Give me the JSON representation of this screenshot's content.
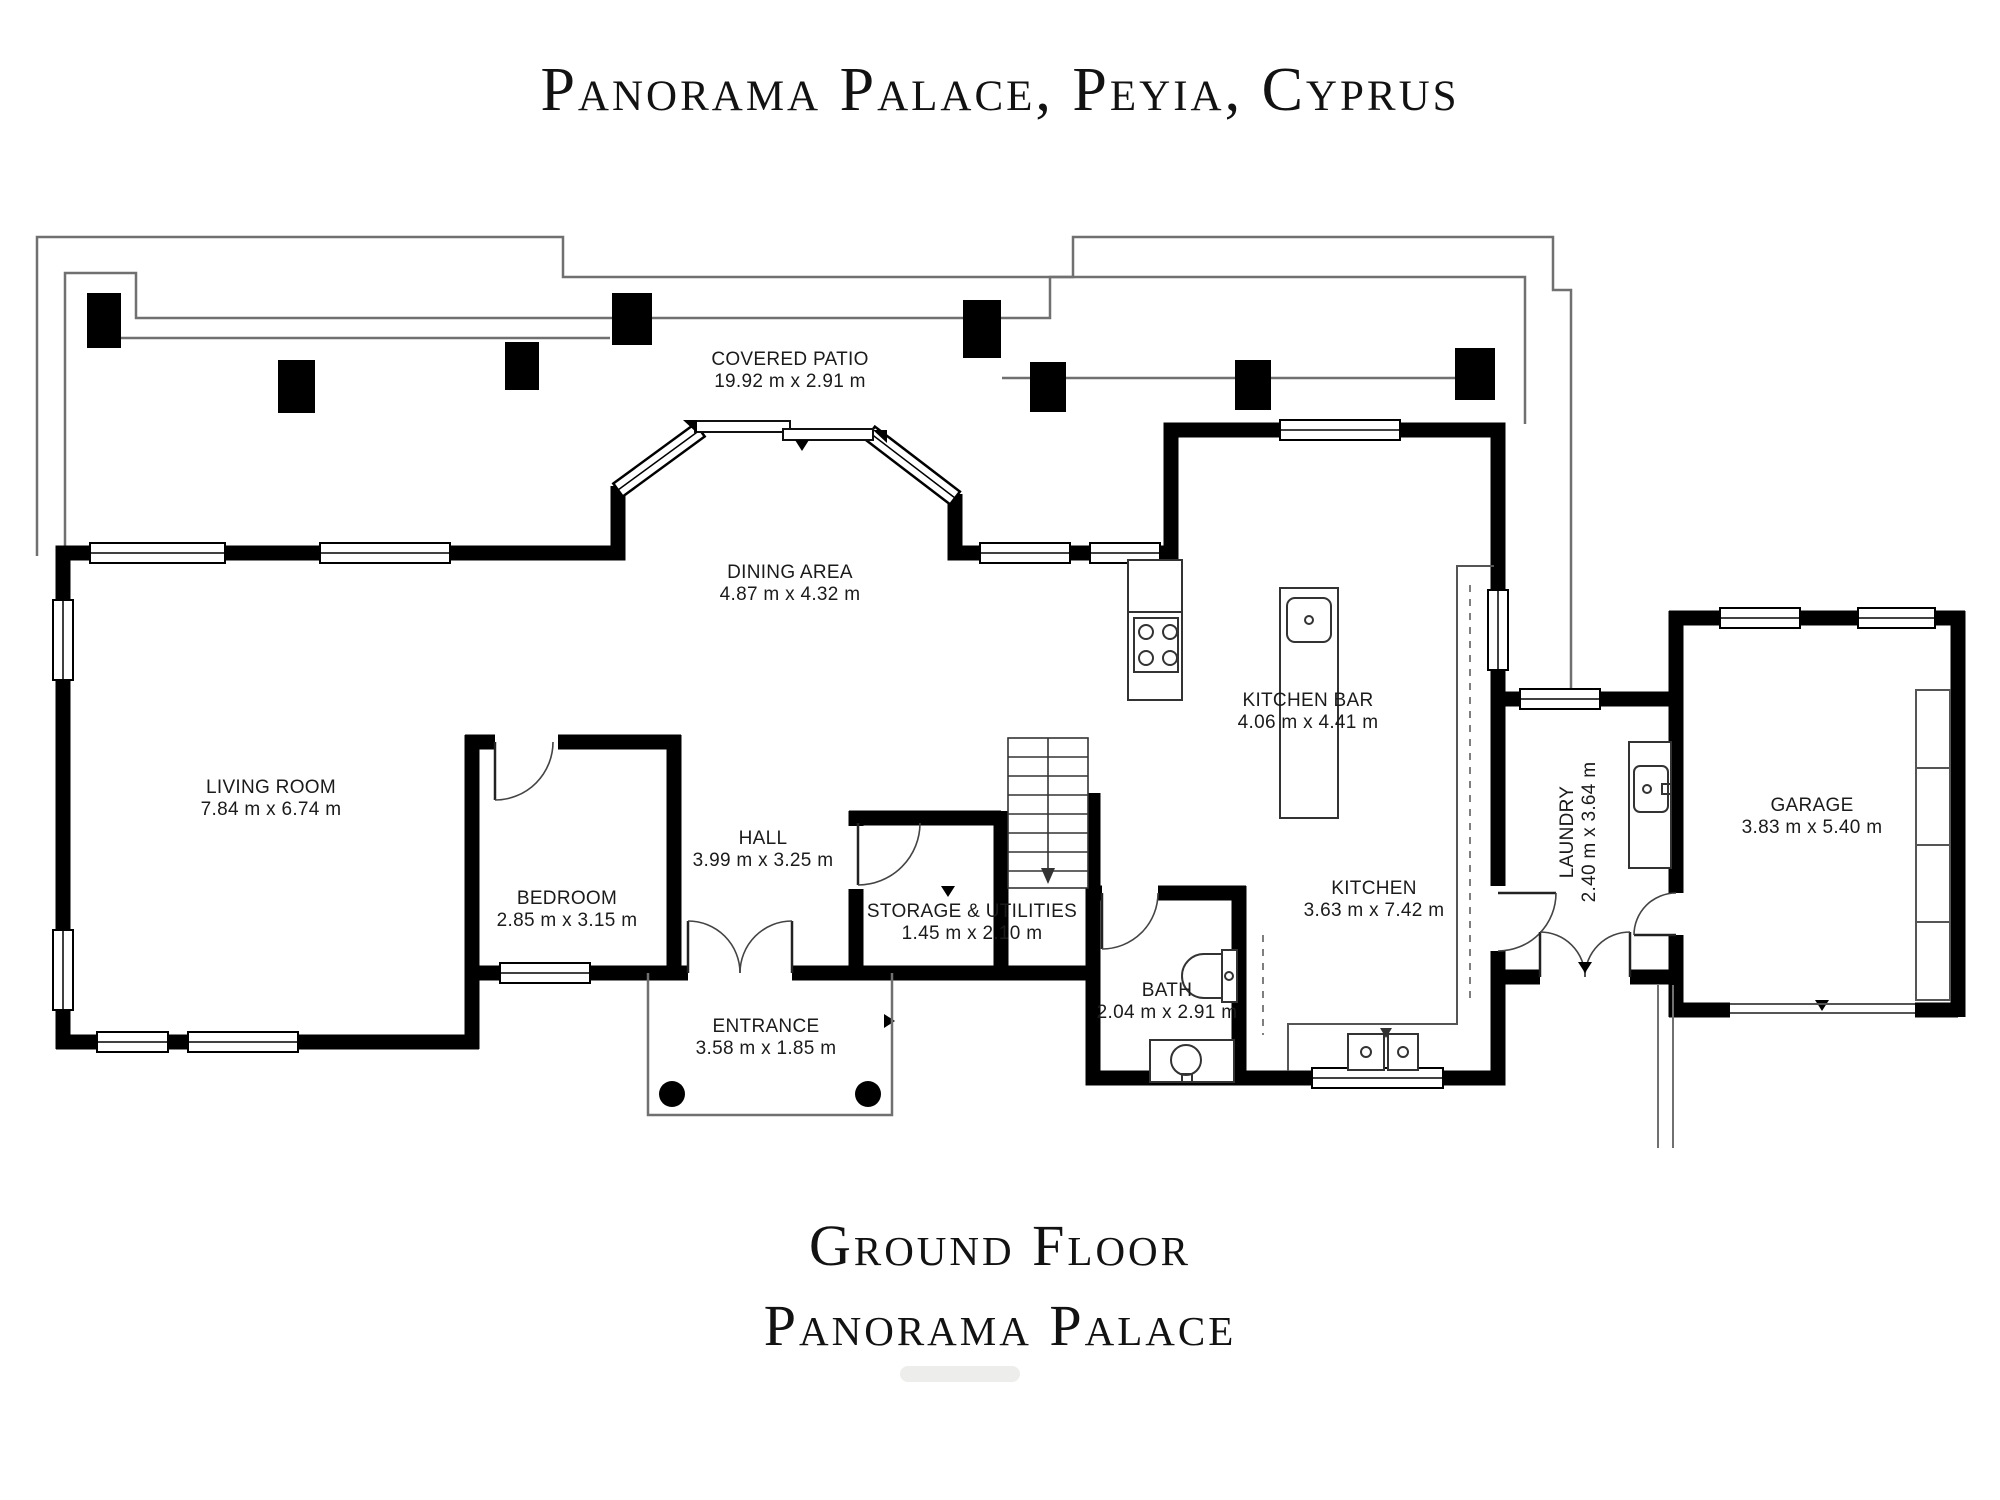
{
  "header": {
    "title": "Panorama Palace, Peyia, Cyprus"
  },
  "footer": {
    "line1": "Ground Floor",
    "line2": "Panorama Palace"
  },
  "colors": {
    "wall": "#000000",
    "thin_line": "#707070",
    "text": "#1b1b1b"
  },
  "rooms": [
    {
      "id": "covered-patio",
      "name": "COVERED PATIO",
      "dims": "19.92 m x 2.91 m"
    },
    {
      "id": "dining-area",
      "name": "DINING AREA",
      "dims": "4.87 m x 4.32 m"
    },
    {
      "id": "living-room",
      "name": "LIVING ROOM",
      "dims": "7.84 m x 6.74 m"
    },
    {
      "id": "bedroom",
      "name": "BEDROOM",
      "dims": "2.85 m x 3.15 m"
    },
    {
      "id": "hall",
      "name": "HALL",
      "dims": "3.99 m x 3.25 m"
    },
    {
      "id": "storage",
      "name": "STORAGE & UTILITIES",
      "dims": "1.45 m x 2.10 m"
    },
    {
      "id": "kitchen-bar",
      "name": "KITCHEN BAR",
      "dims": "4.06 m x 4.41 m"
    },
    {
      "id": "kitchen",
      "name": "KITCHEN",
      "dims": "3.63 m x 7.42 m"
    },
    {
      "id": "laundry",
      "name": "LAUNDRY",
      "dims": "2.40 m x 3.64 m"
    },
    {
      "id": "garage",
      "name": "GARAGE",
      "dims": "3.83 m x 5.40 m"
    },
    {
      "id": "bath",
      "name": "BATH",
      "dims": "2.04 m x 2.91 m"
    },
    {
      "id": "entrance",
      "name": "ENTRANCE",
      "dims": "3.58 m x 1.85 m"
    }
  ]
}
